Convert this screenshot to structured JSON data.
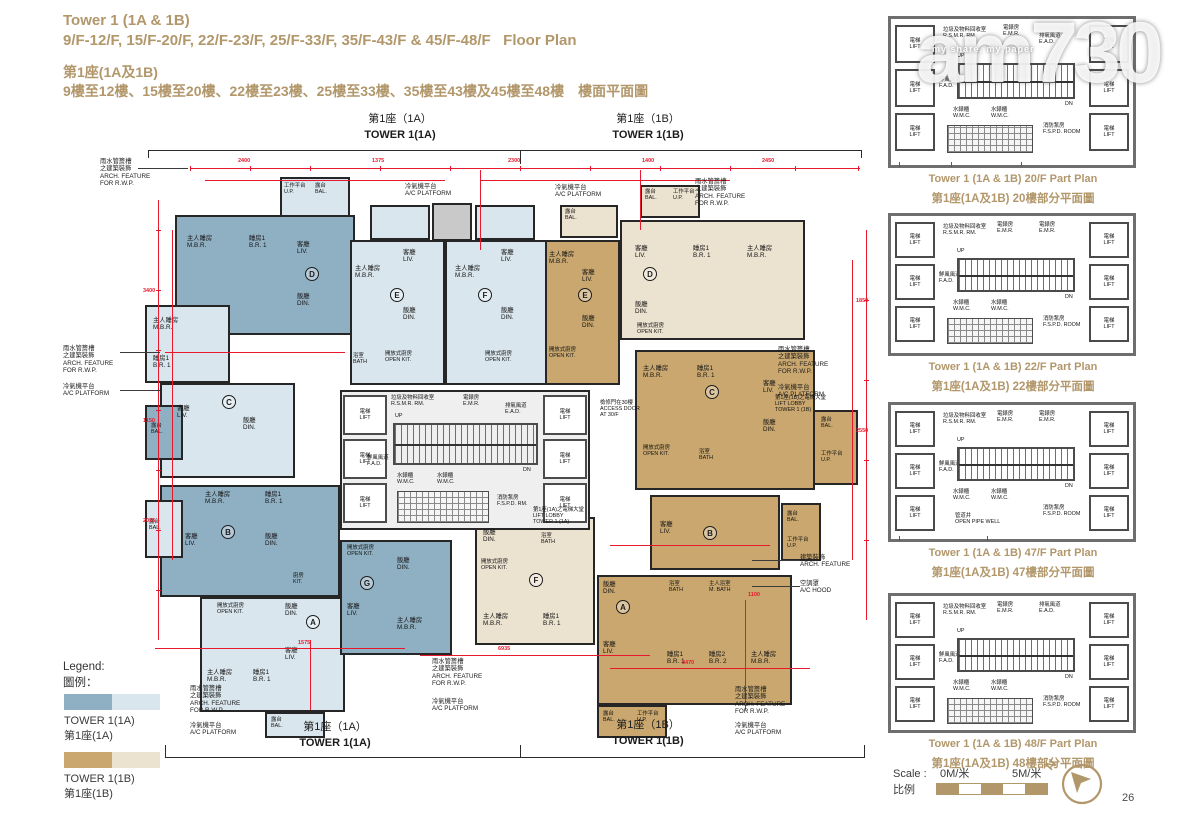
{
  "page": {
    "number": "26"
  },
  "header": {
    "title_en": "Tower 1 (1A & 1B)",
    "subtitle_en": "9/F-12/F, 15/F-20/F, 22/F-23/F, 25/F-33/F, 35/F-43/F & 45/F-48/F   Floor Plan",
    "title_zh": "第1座(1A及1B)",
    "subtitle_zh": "9樓至12樓、15樓至20樓、22樓至23樓、25樓至33樓、35樓至43樓及45樓至48樓　樓面平面圖"
  },
  "watermark": {
    "brand": "am730",
    "tagline": "my share, my paper"
  },
  "plan": {
    "top_labels": [
      {
        "zh": "第1座（1A）",
        "en": "TOWER 1(1A)"
      },
      {
        "zh": "第1座（1B）",
        "en": "TOWER 1(1B)"
      }
    ],
    "bottom_labels": [
      {
        "zh": "第1座（1A）",
        "en": "TOWER 1(1A)"
      },
      {
        "zh": "第1座（1B）",
        "en": "TOWER 1(1B)"
      }
    ],
    "units": {
      "a": "A",
      "b": "B",
      "c": "C",
      "d": "D",
      "e": "E",
      "f": "F",
      "g": "G"
    },
    "rooms": {
      "mbr": {
        "zh": "主人睡房",
        "en": "M.B.R."
      },
      "br1": {
        "zh": "睡房1",
        "en": "B.R. 1"
      },
      "br2": {
        "zh": "睡房2",
        "en": "B.R. 2"
      },
      "liv": {
        "zh": "客廳",
        "en": "LIV."
      },
      "din": {
        "zh": "飯廳",
        "en": "DIN."
      },
      "okit": {
        "zh": "開放式廚房",
        "en": "OPEN KIT."
      },
      "kit": {
        "zh": "廚房",
        "en": "KIT."
      },
      "bath": {
        "zh": "浴室",
        "en": "BATH"
      },
      "mbath": {
        "zh": "主人浴室",
        "en": "M. BATH"
      },
      "bal": {
        "zh": "露台",
        "en": "BAL."
      },
      "up": {
        "zh": "工作平台",
        "en": "U.P."
      },
      "lift": {
        "zh": "電梯",
        "en": "LIFT"
      },
      "emr": {
        "zh": "電錶房",
        "en": "E.M.R."
      },
      "ead": {
        "zh": "排氣風道",
        "en": "E.A.D."
      },
      "fad": {
        "zh": "鮮風風道",
        "en": "F.A.D."
      },
      "wmc": {
        "zh": "水錶櫃",
        "en": "W.M.C."
      },
      "rsmr": {
        "zh": "垃圾及物料回收室",
        "en": "R.S.M.R. RM."
      },
      "fspd": {
        "zh": "消防泵房",
        "en": "F.S.P.D. RM."
      },
      "fspd_room": {
        "zh": "消防泵房",
        "en": "F.S.P.D. ROOM"
      },
      "open_pipe": {
        "zh": "管道井",
        "en": "OPEN PIPE WELL"
      },
      "stair_up": "UP",
      "stair_dn": "DN"
    },
    "callouts": {
      "arch_rwp": {
        "zh1": "雨水管簷槽",
        "zh2": "之建築裝飾",
        "en1": "ARCH. FEATURE",
        "en2": "FOR R.W.P."
      },
      "ac_platform": {
        "zh": "冷氣機平台",
        "en": "A/C PLATFORM"
      },
      "arch_feature": {
        "zh": "建築裝飾",
        "en": "ARCH. FEATURE"
      },
      "ac_hood": {
        "zh": "空調罩",
        "en": "A/C HOOD"
      },
      "access_door": {
        "zh": "檢修門在30樓",
        "en1": "ACCESS DOOR",
        "en2": "AT 30/F"
      },
      "lobby_1a": {
        "zh": "第1座(1A)之電梯大堂",
        "en1": "LIFT LOBBY",
        "en2": "TOWER 1 (1A)"
      },
      "lobby_1b": {
        "zh": "第1座(1B)之電梯大堂",
        "en1": "LIFT LOBBY",
        "en2": "TOWER 1 (1B)"
      }
    },
    "dims": [
      "2400",
      "1375",
      "2300",
      "1400",
      "2450",
      "3400",
      "1150",
      "2025",
      "6935",
      "3470",
      "1850",
      "2550",
      "1575",
      "1100"
    ]
  },
  "legend": {
    "title_en": "Legend:",
    "title_zh": "圖例：",
    "items": [
      {
        "label_en": "TOWER 1(1A)",
        "label_zh": "第1座(1A)",
        "color_dark": "#8fb0c2",
        "color_light": "#d9e6ed"
      },
      {
        "label_en": "TOWER 1(1B)",
        "label_zh": "第1座(1B)",
        "color_dark": "#c9a76f",
        "color_light": "#ece2d0"
      }
    ]
  },
  "part_plans": [
    {
      "caption_en": "Tower 1 (1A & 1B) 20/F Part Plan",
      "caption_zh": "第1座(1A及1B) 20樓部分平面圖"
    },
    {
      "caption_en": "Tower 1 (1A & 1B) 22/F Part Plan",
      "caption_zh": "第1座(1A及1B) 22樓部分平面圖"
    },
    {
      "caption_en": "Tower 1 (1A & 1B) 47/F Part Plan",
      "caption_zh": "第1座(1A及1B) 47樓部分平面圖"
    },
    {
      "caption_en": "Tower 1 (1A & 1B) 48/F Part Plan",
      "caption_zh": "第1座(1A及1B) 48樓部分平面圖"
    }
  ],
  "scale": {
    "label_en": "Scale :",
    "label_zh": "比例",
    "start": "0M/米",
    "end": "5M/米",
    "north": "N"
  },
  "colors": {
    "accent": "#b2976b",
    "dimension_red": "#e8192c",
    "tower_1a_dark": "#8fb0c2",
    "tower_1a_light": "#d9e6ed",
    "tower_1b_dark": "#c9a76f",
    "tower_1b_light": "#ece2d0"
  }
}
